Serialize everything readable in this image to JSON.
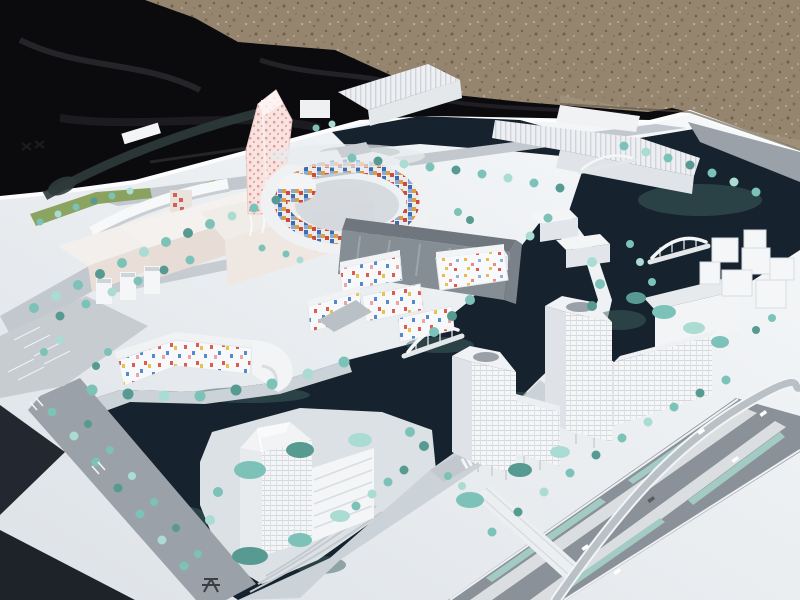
{
  "scene": {
    "description": "Outdoor photograph of a white architectural scale model of a waterfront urban district, laid on a white base board placed over a black tarp on gravel ground, shot at an oblique aerial angle in bright sunlight.",
    "environment": [
      "black-tarp",
      "gravel-ground",
      "white-base-board",
      "cast-shadows-on-board"
    ],
    "model_features": [
      "pink-checkered-twisting-tower",
      "oval-ring-building-with-colorful-mosaic-courtyard-facade",
      "colorful-confetti-windowed-low-rise-blocks",
      "large-gray-glass-slab-building",
      "white-gridded-highrise-towers",
      "translucent-faceted-corner-tower",
      "dark-navy-canals-and-basins",
      "white-arched-pedestrian-bridges",
      "teal-model-trees-along-avenues-and-banks",
      "striped-parking-lots",
      "multi-lane-boulevard-with-planted-medians",
      "curved-flyover-ramp",
      "tiny-model-cars",
      "illegible-dark-markings-on-board"
    ]
  },
  "palette": {
    "tarp": "#0b0b0e",
    "tarp_fold": "#2b2b31",
    "gravel": "#95856f",
    "gravel_dark": "#6f5f4a",
    "gravel_light": "#b7a991",
    "board_light": "#f7f9fa",
    "board_shade": "#dde2e7",
    "board_edge": "#fdfdfe",
    "cast_shadow": "#12181f",
    "water": "#16232e",
    "water_teal": "#3d5f5e",
    "tree": "#7dc2b8",
    "tree_light": "#aadcd3",
    "tree_dark": "#569a91",
    "lawn": "#86a058",
    "road": "#9aa1a9",
    "road_light": "#c2c8cd",
    "road_dark": "#8a9198",
    "median": "#dadee1",
    "lane_teal": "#a3cbc4",
    "bldg_white": "#f5f6f8",
    "bldg_face": "#e4e8eb",
    "bldg_shade": "#c4cad1",
    "bldg_roof": "#d0d5da",
    "bldg_gray": "#858d95",
    "cream": "#eadfd8",
    "pink_tint": "#ecd9d4",
    "pink_dot": "#e59a93",
    "tile_red": "#cf4a3d",
    "tile_blue": "#3d6cb0",
    "tile_orange": "#de9b40",
    "tile_sky": "#88acd7",
    "confetti_red": "#e05a52",
    "confetti_blue": "#5588cc",
    "confetti_yellow": "#e7c24e",
    "confetti_pink": "#eda4a6",
    "bridge": "#eff2f4",
    "car": "#ffffff"
  }
}
